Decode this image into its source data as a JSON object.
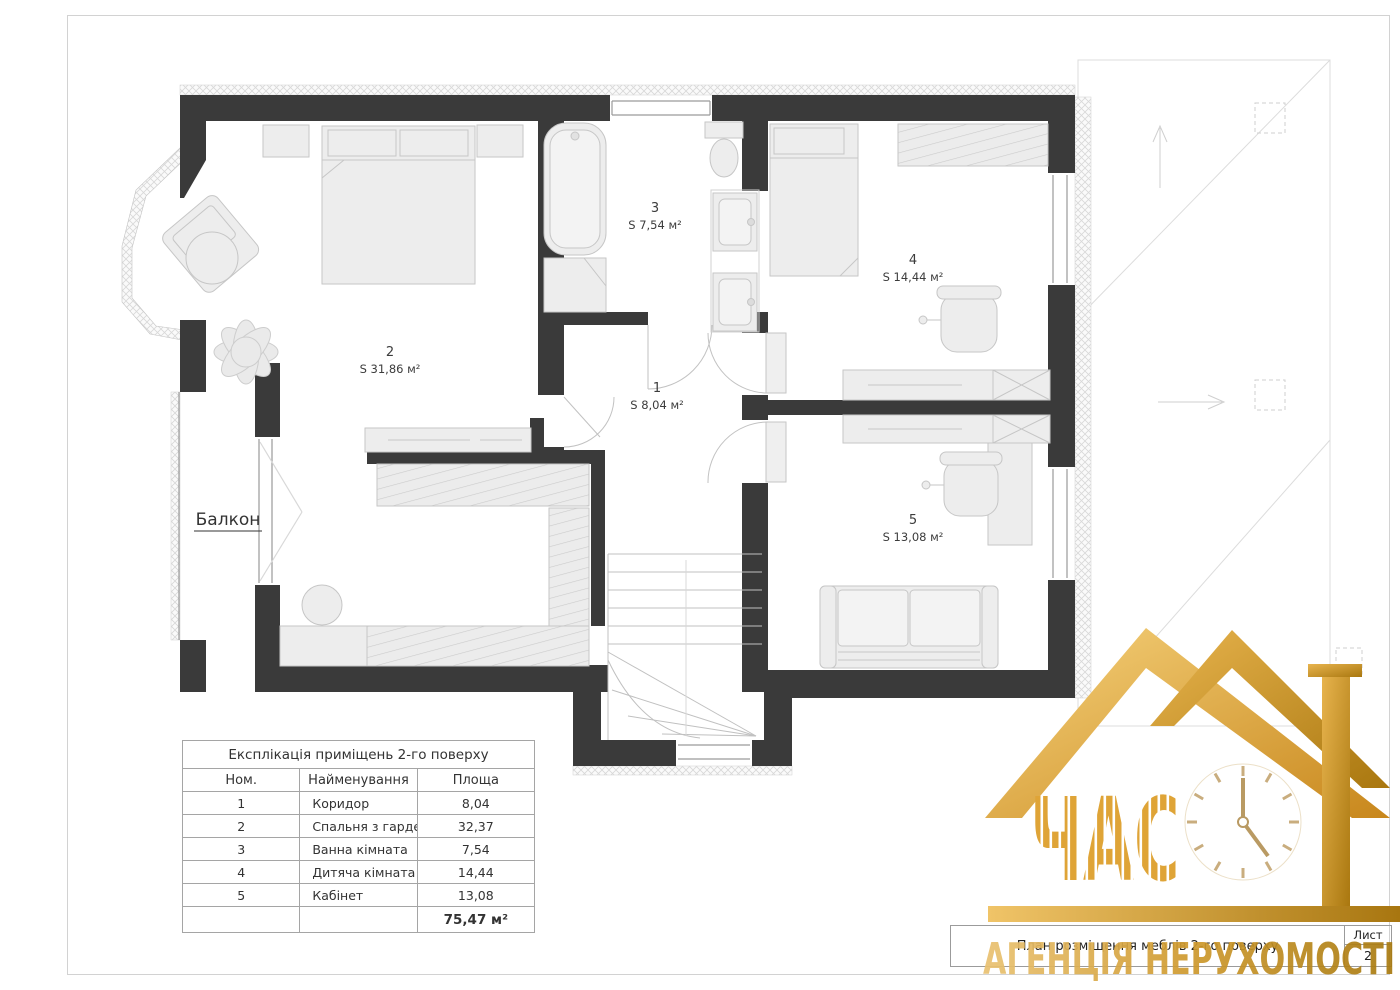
{
  "page": {
    "sheet_label": "Лист",
    "sheet_number": "2",
    "title_block_text": "План розміщення меблів 2-го поверху"
  },
  "plan": {
    "balcony_label": "Балкон",
    "rooms": [
      {
        "num": "1",
        "area": "S 8,04 м²"
      },
      {
        "num": "2",
        "area": "S 31,86 м²"
      },
      {
        "num": "3",
        "area": "S 7,54 м²"
      },
      {
        "num": "4",
        "area": "S 14,44 м²"
      },
      {
        "num": "5",
        "area": "S 13,08 м²"
      }
    ]
  },
  "legend_table": {
    "title": "Експлікація приміщень 2-го поверху",
    "headers": {
      "num": "Ном.",
      "name": "Найменування",
      "area": "Площа"
    },
    "rows": [
      {
        "num": "1",
        "name": "Коридор",
        "area": "8,04"
      },
      {
        "num": "2",
        "name": "Спальня з гардеробною",
        "area": "32,37"
      },
      {
        "num": "3",
        "name": "Ванна кімната",
        "area": "7,54"
      },
      {
        "num": "4",
        "name": "Дитяча кімната",
        "area": "14,44"
      },
      {
        "num": "5",
        "name": "Кабінет",
        "area": "13,08"
      }
    ],
    "total": "75,47 м²"
  },
  "logo": {
    "brand": "ЧАС",
    "agency": "АГЕНЦІЯ НЕРУХОМОСТІ"
  },
  "colors": {
    "wall": "#3a3a3a",
    "furniture_fill": "#ededed",
    "gold_light": "#f3c96b",
    "gold_dark": "#b8860b"
  }
}
